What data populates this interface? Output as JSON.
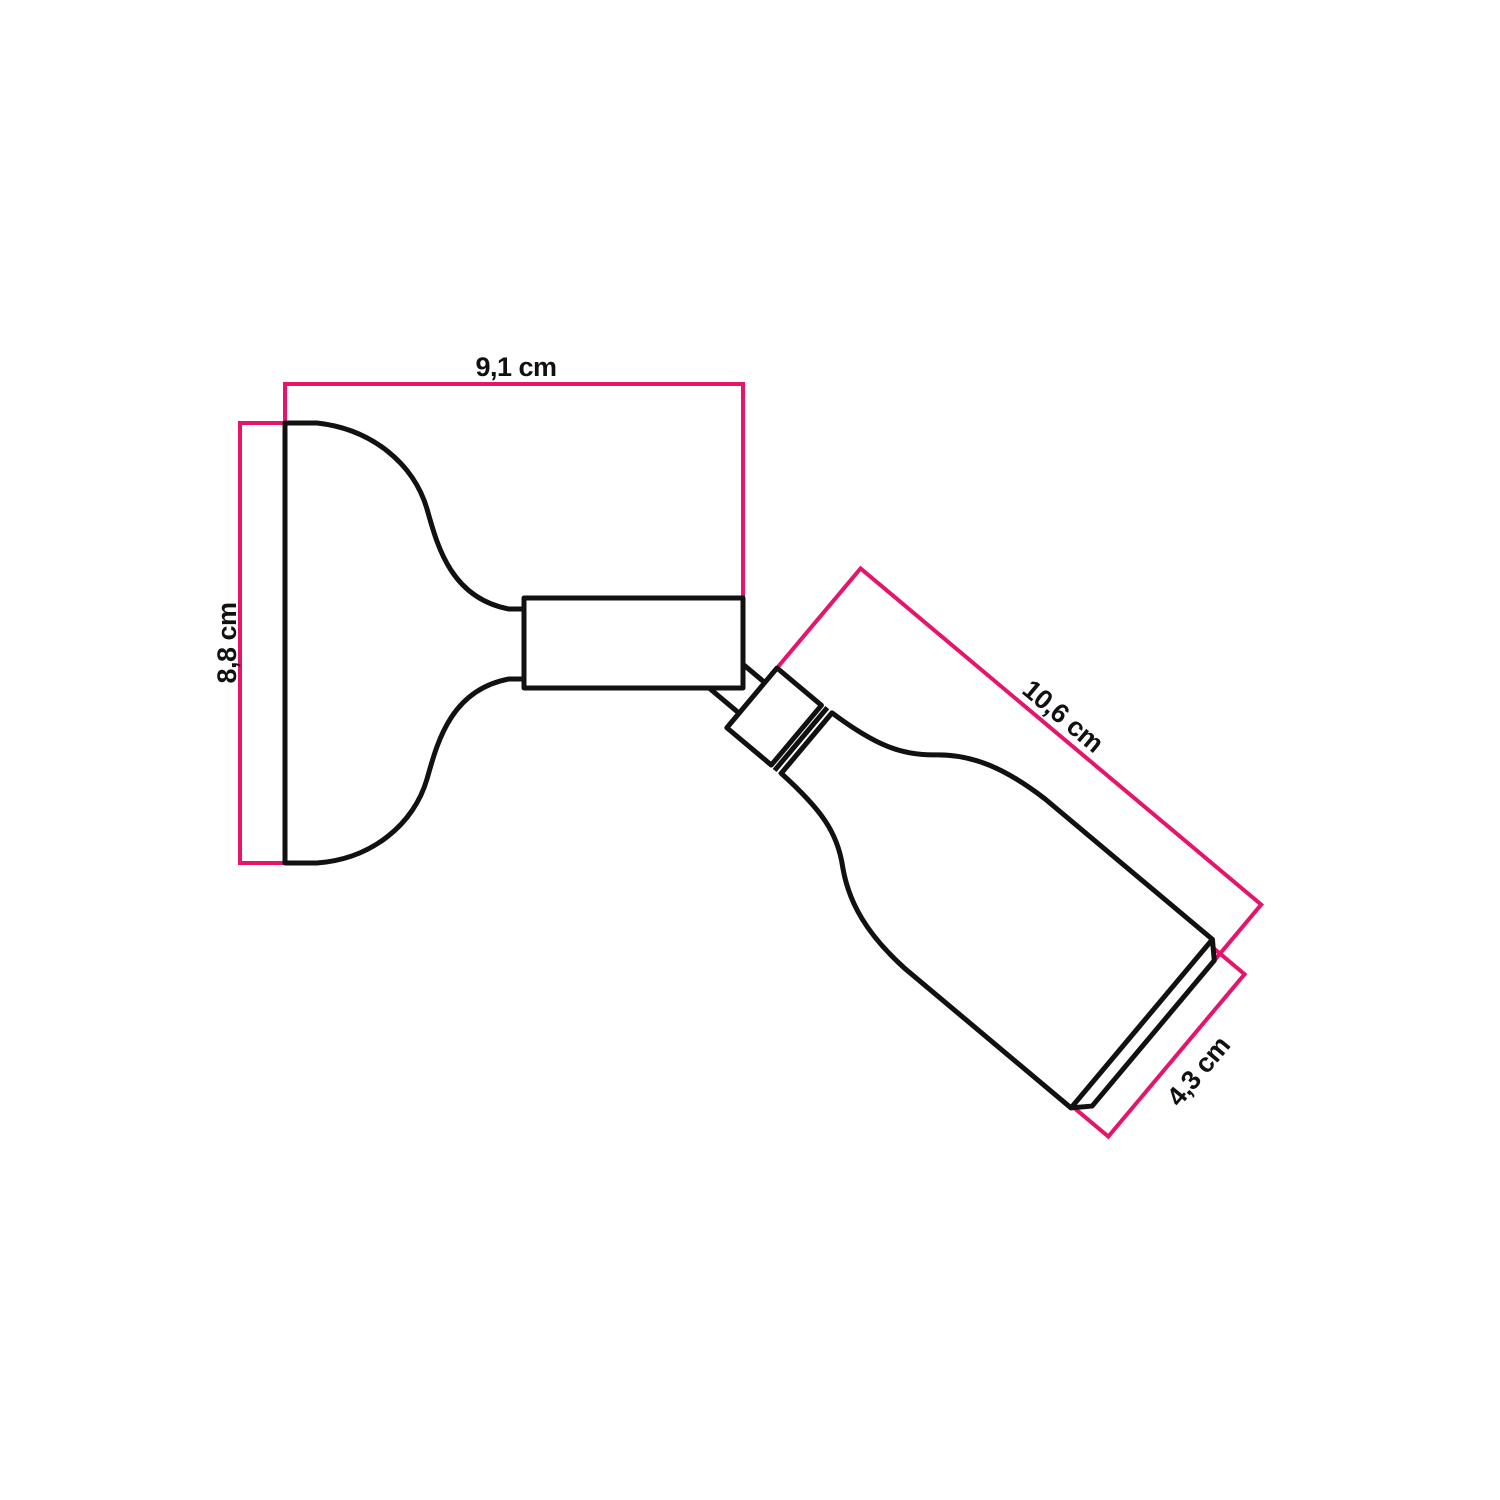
{
  "diagram": {
    "title": "Adjustable wall spotlight dimension drawing",
    "unit": "cm",
    "labels": {
      "width": "9,1 cm",
      "height": "8,8 cm",
      "length": "10,6 cm",
      "diameter": "4,3 cm"
    },
    "colors": {
      "dimension": "#e4156b",
      "outline": "#111111",
      "background": "#ffffff"
    }
  }
}
